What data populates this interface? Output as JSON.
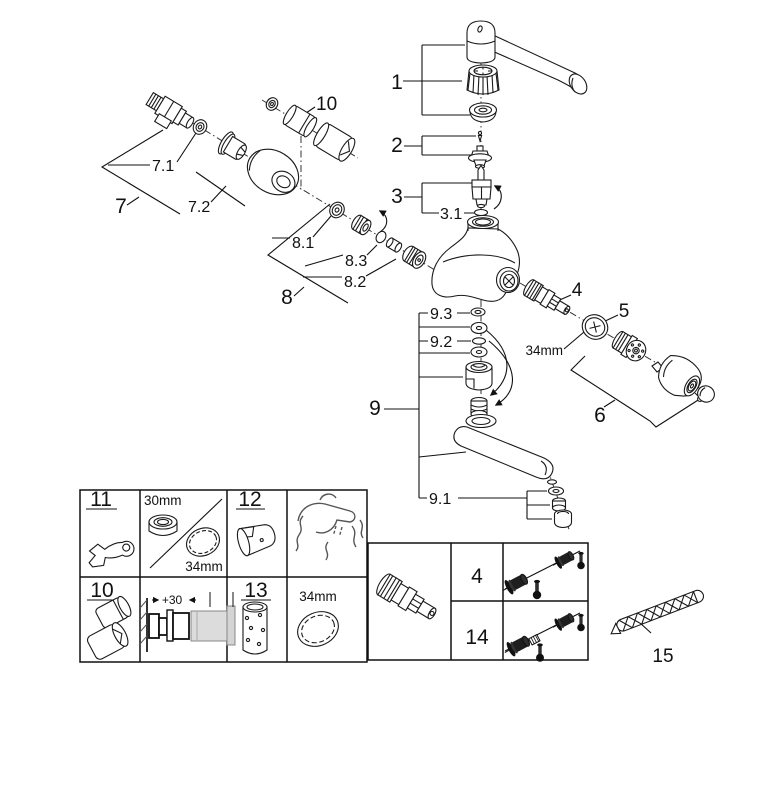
{
  "figure": {
    "kind": "exploded-parts-diagram",
    "background": "#ffffff",
    "ink": "#1a1a1a"
  },
  "callouts": {
    "n1": "1",
    "n2": "2",
    "n3": "3",
    "n3_1": "3.1",
    "n4": "4",
    "n5": "5",
    "n6": "6",
    "n7": "7",
    "n7_1": "7.1",
    "n7_2": "7.2",
    "n8": "8",
    "n8_1": "8.1",
    "n8_2": "8.2",
    "n8_3": "8.3",
    "n9": "9",
    "n9_1": "9.1",
    "n9_2": "9.2",
    "n9_3": "9.3",
    "n10": "10",
    "n15": "15",
    "dim_34mm": "34mm"
  },
  "legend_table": {
    "cell_11": "11",
    "cell_12": "12",
    "cell_10": "10",
    "cell_13": "13",
    "dim_30mm": "30mm",
    "dim_34mm_top": "34mm",
    "dim_34mm_bottom": "34mm",
    "dim_plus30": "+30"
  },
  "screw_panel": {
    "row_top": "4",
    "row_bottom": "14"
  }
}
